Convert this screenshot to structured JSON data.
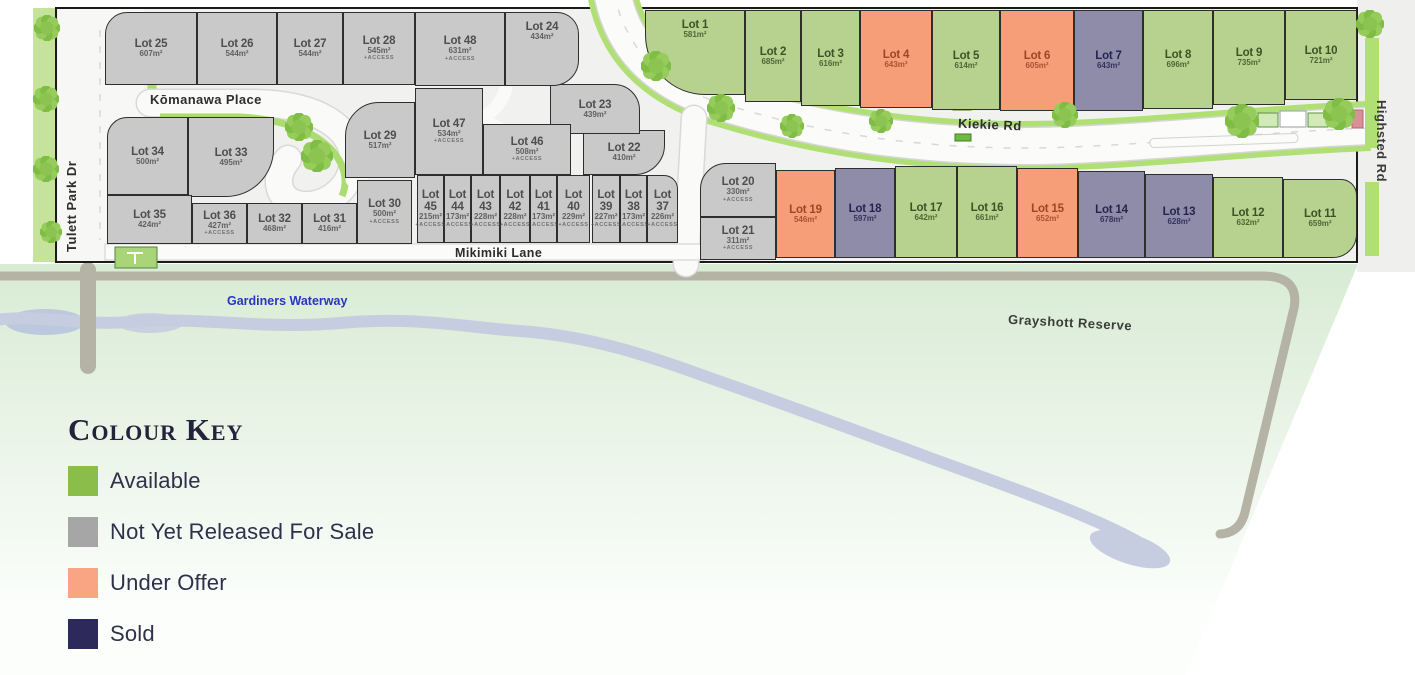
{
  "legend": {
    "title": "Colour Key",
    "order": [
      "available",
      "not_released",
      "under_offer",
      "sold"
    ]
  },
  "statuses": {
    "available": {
      "label": "Available",
      "swatch": "#8abd4a",
      "map_fill": "#b7d18f",
      "text": "#3e5226"
    },
    "not_released": {
      "label": "Not Yet Released For Sale",
      "swatch": "#a6a6a6",
      "map_fill": "#c9c9c9",
      "text": "#4e4e4e"
    },
    "under_offer": {
      "label": "Under Offer",
      "swatch": "#f9a584",
      "map_fill": "#f59e78",
      "text": "#9e4526"
    },
    "sold": {
      "label": "Sold",
      "swatch": "#2d2a5b",
      "map_fill": "#8f8ca9",
      "text": "#262350"
    }
  },
  "streets": {
    "tulett": "Tulett Park Dr",
    "komanawa": "Kōmanawa Place",
    "kiekie": "Kiekie Rd",
    "mikimiki": "Mikimiki Lane",
    "highsted": "Highsted Rd"
  },
  "features": {
    "waterway": "Gardiners Waterway",
    "reserve": "Grayshott Reserve"
  },
  "lots": [
    {
      "id": 1,
      "label": "Lot 1",
      "area": "581m²",
      "status": "available",
      "x": 645,
      "y": 10,
      "w": 100,
      "h": 85,
      "radius": "0 0 0 60px",
      "label_at": "top"
    },
    {
      "id": 2,
      "label": "Lot 2",
      "area": "685m²",
      "status": "available",
      "x": 745,
      "y": 10,
      "w": 56,
      "h": 92
    },
    {
      "id": 3,
      "label": "Lot 3",
      "area": "616m²",
      "status": "available",
      "x": 801,
      "y": 10,
      "w": 59,
      "h": 96
    },
    {
      "id": 4,
      "label": "Lot 4",
      "area": "643m²",
      "status": "under_offer",
      "x": 860,
      "y": 10,
      "w": 72,
      "h": 98
    },
    {
      "id": 5,
      "label": "Lot 5",
      "area": "614m²",
      "status": "available",
      "x": 932,
      "y": 10,
      "w": 68,
      "h": 100
    },
    {
      "id": 6,
      "label": "Lot 6",
      "area": "605m²",
      "status": "under_offer",
      "x": 1000,
      "y": 10,
      "w": 74,
      "h": 101
    },
    {
      "id": 7,
      "label": "Lot 7",
      "area": "643m²",
      "status": "sold",
      "x": 1074,
      "y": 10,
      "w": 69,
      "h": 101
    },
    {
      "id": 8,
      "label": "Lot 8",
      "area": "696m²",
      "status": "available",
      "x": 1143,
      "y": 10,
      "w": 70,
      "h": 99
    },
    {
      "id": 9,
      "label": "Lot 9",
      "area": "735m²",
      "status": "available",
      "x": 1213,
      "y": 10,
      "w": 72,
      "h": 95
    },
    {
      "id": 10,
      "label": "Lot 10",
      "area": "721m²",
      "status": "available",
      "x": 1285,
      "y": 10,
      "w": 72,
      "h": 90
    },
    {
      "id": 11,
      "label": "Lot 11",
      "area": "659m²",
      "status": "available",
      "x": 1283,
      "y": 179,
      "w": 74,
      "h": 79,
      "radius": "0 16px 24px 0"
    },
    {
      "id": 12,
      "label": "Lot 12",
      "area": "632m²",
      "status": "available",
      "x": 1213,
      "y": 177,
      "w": 70,
      "h": 81
    },
    {
      "id": 13,
      "label": "Lot 13",
      "area": "628m²",
      "status": "sold",
      "x": 1145,
      "y": 174,
      "w": 68,
      "h": 84
    },
    {
      "id": 14,
      "label": "Lot 14",
      "area": "678m²",
      "status": "sold",
      "x": 1078,
      "y": 171,
      "w": 67,
      "h": 87
    },
    {
      "id": 15,
      "label": "Lot 15",
      "area": "652m²",
      "status": "under_offer",
      "x": 1017,
      "y": 168,
      "w": 61,
      "h": 90
    },
    {
      "id": 16,
      "label": "Lot 16",
      "area": "661m²",
      "status": "available",
      "x": 957,
      "y": 166,
      "w": 60,
      "h": 92
    },
    {
      "id": 17,
      "label": "Lot 17",
      "area": "642m²",
      "status": "available",
      "x": 895,
      "y": 166,
      "w": 62,
      "h": 92
    },
    {
      "id": 18,
      "label": "Lot 18",
      "area": "597m²",
      "status": "sold",
      "x": 835,
      "y": 168,
      "w": 60,
      "h": 90
    },
    {
      "id": 19,
      "label": "Lot 19",
      "area": "546m²",
      "status": "under_offer",
      "x": 776,
      "y": 170,
      "w": 59,
      "h": 88
    },
    {
      "id": 20,
      "label": "Lot 20",
      "area": "330m²",
      "status": "not_released",
      "access": "+ACCESS",
      "x": 700,
      "y": 163,
      "w": 76,
      "h": 54,
      "radius": "26px 0 0 0"
    },
    {
      "id": 21,
      "label": "Lot 21",
      "area": "311m²",
      "status": "not_released",
      "access": "+ACCESS",
      "x": 700,
      "y": 217,
      "w": 76,
      "h": 43
    },
    {
      "id": 22,
      "label": "Lot 22",
      "area": "410m²",
      "status": "not_released",
      "x": 583,
      "y": 130,
      "w": 82,
      "h": 45,
      "radius": "0 0 30px 0"
    },
    {
      "id": 23,
      "label": "Lot 23",
      "area": "439m²",
      "status": "not_released",
      "x": 550,
      "y": 84,
      "w": 90,
      "h": 50,
      "radius": "0 26px 0 0"
    },
    {
      "id": 24,
      "label": "Lot 24",
      "area": "434m²",
      "status": "not_released",
      "x": 505,
      "y": 12,
      "w": 74,
      "h": 74,
      "radius": "0 22px 26px 0",
      "label_at": "top"
    },
    {
      "id": 25,
      "label": "Lot 25",
      "area": "607m²",
      "status": "not_released",
      "x": 105,
      "y": 12,
      "w": 92,
      "h": 73,
      "radius": "22px 0 0 0"
    },
    {
      "id": 26,
      "label": "Lot 26",
      "area": "544m²",
      "status": "not_released",
      "x": 197,
      "y": 12,
      "w": 80,
      "h": 73
    },
    {
      "id": 27,
      "label": "Lot 27",
      "area": "544m²",
      "status": "not_released",
      "x": 277,
      "y": 12,
      "w": 66,
      "h": 73
    },
    {
      "id": 28,
      "label": "Lot 28",
      "area": "545m²",
      "status": "not_released",
      "access": "+ACCESS",
      "x": 343,
      "y": 12,
      "w": 72,
      "h": 73
    },
    {
      "id": 29,
      "label": "Lot 29",
      "area": "517m²",
      "status": "not_released",
      "x": 345,
      "y": 102,
      "w": 70,
      "h": 76,
      "radius": "34px 0 0 0"
    },
    {
      "id": 30,
      "label": "Lot 30",
      "area": "500m²",
      "status": "not_released",
      "access": "+ACCESS",
      "x": 357,
      "y": 180,
      "w": 55,
      "h": 64
    },
    {
      "id": 31,
      "label": "Lot 31",
      "area": "416m²",
      "status": "not_released",
      "x": 302,
      "y": 203,
      "w": 55,
      "h": 41
    },
    {
      "id": 32,
      "label": "Lot 32",
      "area": "468m²",
      "status": "not_released",
      "x": 247,
      "y": 203,
      "w": 55,
      "h": 41
    },
    {
      "id": 33,
      "label": "Lot 33",
      "area": "495m²",
      "status": "not_released",
      "x": 188,
      "y": 117,
      "w": 86,
      "h": 80,
      "radius": "0 0 48px 0"
    },
    {
      "id": 34,
      "label": "Lot 34",
      "area": "500m²",
      "status": "not_released",
      "x": 107,
      "y": 117,
      "w": 81,
      "h": 78,
      "radius": "20px 0 0 0"
    },
    {
      "id": 35,
      "label": "Lot 35",
      "area": "424m²",
      "status": "not_released",
      "x": 107,
      "y": 195,
      "w": 85,
      "h": 49
    },
    {
      "id": 36,
      "label": "Lot 36",
      "area": "427m²",
      "status": "not_released",
      "access": "+ACCESS",
      "x": 192,
      "y": 203,
      "w": 55,
      "h": 41
    },
    {
      "id": 37,
      "label": "Lot 37",
      "area": "226m²",
      "status": "not_released",
      "access": "+ACCESS",
      "x": 647,
      "y": 175,
      "w": 31,
      "h": 68,
      "radius": "0 14px 0 0"
    },
    {
      "id": 38,
      "label": "Lot 38",
      "area": "173m²",
      "status": "not_released",
      "access": "+ACCESS",
      "x": 620,
      "y": 175,
      "w": 27,
      "h": 68
    },
    {
      "id": 39,
      "label": "Lot 39",
      "area": "227m²",
      "status": "not_released",
      "access": "+ACCESS",
      "x": 592,
      "y": 175,
      "w": 28,
      "h": 68
    },
    {
      "id": 40,
      "label": "Lot 40",
      "area": "229m²",
      "status": "not_released",
      "access": "+ACCESS",
      "x": 557,
      "y": 175,
      "w": 33,
      "h": 68
    },
    {
      "id": 41,
      "label": "Lot 41",
      "area": "173m²",
      "status": "not_released",
      "access": "+ACCESS",
      "x": 530,
      "y": 175,
      "w": 27,
      "h": 68
    },
    {
      "id": 42,
      "label": "Lot 42",
      "area": "228m²",
      "status": "not_released",
      "access": "+ACCESS",
      "x": 500,
      "y": 175,
      "w": 30,
      "h": 68
    },
    {
      "id": 43,
      "label": "Lot 43",
      "area": "228m²",
      "status": "not_released",
      "access": "+ACCESS",
      "x": 471,
      "y": 175,
      "w": 29,
      "h": 68
    },
    {
      "id": 44,
      "label": "Lot 44",
      "area": "173m²",
      "status": "not_released",
      "access": "+ACCESS",
      "x": 444,
      "y": 175,
      "w": 27,
      "h": 68
    },
    {
      "id": 45,
      "label": "Lot 45",
      "area": "215m²",
      "status": "not_released",
      "access": "+ACCESS",
      "x": 417,
      "y": 175,
      "w": 27,
      "h": 68
    },
    {
      "id": 46,
      "label": "Lot 46",
      "area": "508m²",
      "status": "not_released",
      "access": "+ACCESS",
      "x": 483,
      "y": 124,
      "w": 88,
      "h": 51
    },
    {
      "id": 47,
      "label": "Lot 47",
      "area": "534m²",
      "status": "not_released",
      "access": "+ACCESS",
      "x": 415,
      "y": 88,
      "w": 68,
      "h": 87
    },
    {
      "id": 48,
      "label": "Lot 48",
      "area": "631m²",
      "status": "not_released",
      "access": "+ACCESS",
      "x": 415,
      "y": 12,
      "w": 90,
      "h": 74
    }
  ]
}
